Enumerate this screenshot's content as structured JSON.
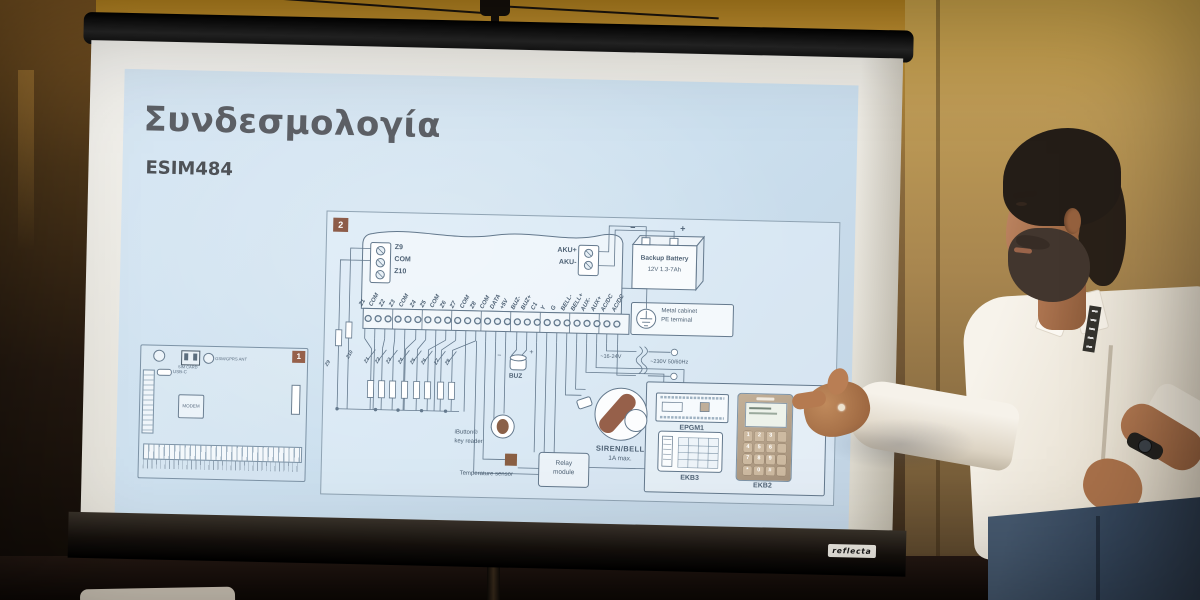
{
  "slide": {
    "title": "Συνδεσμολογία",
    "subtitle": "ESIM484"
  },
  "pcb": {
    "badge": "1",
    "usb_label": "USB-C",
    "sim_label": "SIM CARD",
    "antenna_label": "GSM/GPRS ANT",
    "modem_label": "MODEM"
  },
  "diagram": {
    "badge": "2",
    "io_block": {
      "t1": "Z9",
      "t2": "COM",
      "t3": "Z10"
    },
    "aku": {
      "plus": "AKU+",
      "minus": "AKU-"
    },
    "battery": {
      "minus_sign": "−",
      "plus_sign": "+",
      "line1": "Backup Battery",
      "line2": "12V 1.3-7Ah"
    },
    "pe": {
      "line1": "Metal cabinet",
      "line2": "PE terminal"
    },
    "terminals": [
      "Z1",
      "COM",
      "Z2",
      "Z3",
      "COM",
      "Z4",
      "Z5",
      "COM",
      "Z6",
      "Z7",
      "COM",
      "Z8",
      "COM",
      "DATA",
      "+5V",
      "BUZ-",
      "BUZ+",
      "C1",
      "Y",
      "G",
      "BELL-",
      "BELL+",
      "AUX-",
      "AUX+",
      "AC/DC",
      "AC/DC"
    ],
    "left_zones": [
      "Z9",
      "Z10"
    ],
    "zones": [
      "Z1",
      "Z2",
      "Z3",
      "Z4",
      "Z5",
      "Z6",
      "Z7",
      "Z8"
    ],
    "buzzer": {
      "minus": "−",
      "plus": "+",
      "label": "BUZ"
    },
    "ibutton": {
      "line1": "iButton®",
      "line2": "key reader"
    },
    "temp_label": "Temperature sensor",
    "relay": {
      "line1": "Relay",
      "line2": "module"
    },
    "siren": {
      "line1": "SIREN/BELL",
      "line2": "1A max."
    },
    "power": {
      "low": "~16-24V",
      "mains": "~230V 50/60Hz"
    },
    "epgm1_label": "EPGM1",
    "ekb3_label": "EKB3",
    "ekb2_label": "EKB2",
    "keypad_keys": [
      "1",
      "2",
      "3",
      "4",
      "5",
      "6",
      "7",
      "8",
      "9",
      "*",
      "0",
      "#"
    ]
  },
  "projector_screen": {
    "brand": "reflecta"
  }
}
